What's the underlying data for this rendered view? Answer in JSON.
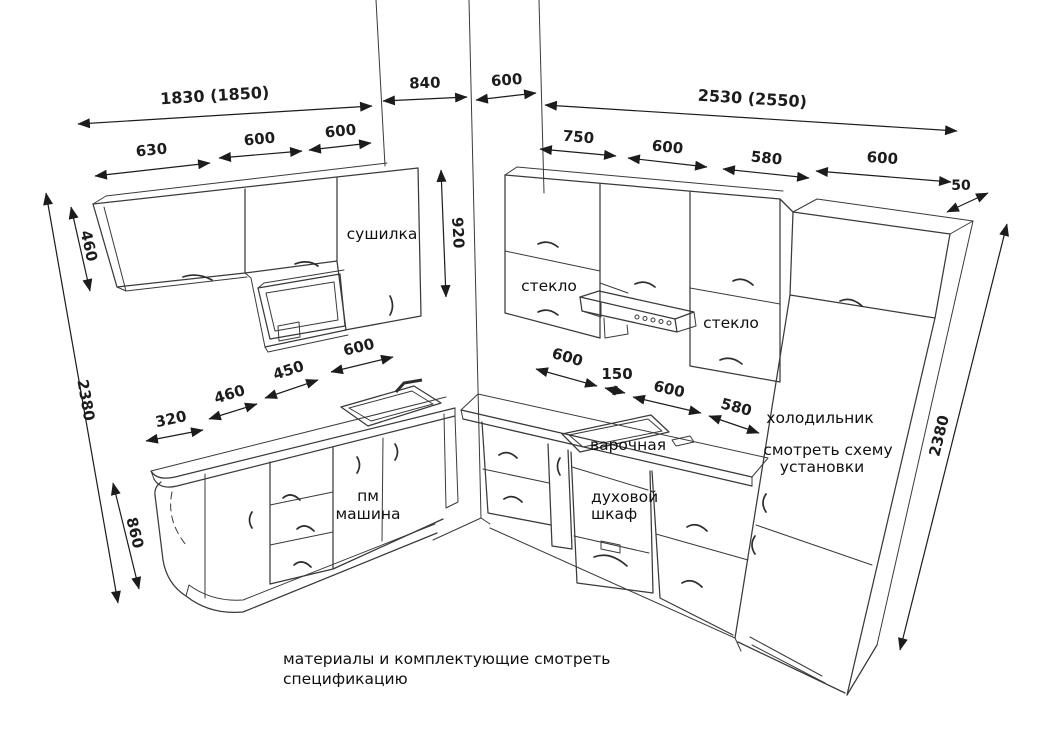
{
  "drawing": {
    "labels": {
      "dryer": "сушилка",
      "glass_left": "стекло",
      "glass_right": "стекло",
      "fridge_1": "холодильник",
      "fridge_2": "смотреть схему",
      "fridge_3": "установки",
      "hob": "варочная",
      "oven_1": "духовой",
      "oven_2": "шкаф",
      "dishwasher_1": "пм",
      "dishwasher_2": "машина"
    },
    "dims": {
      "total_left": "1830 (1850)",
      "left_sections": [
        "630",
        "600",
        "600"
      ],
      "wall_left": "840",
      "wall_right": "600",
      "total_right": "2530 (2550)",
      "right_sections": [
        "750",
        "600",
        "580",
        "600"
      ],
      "overhang": "50",
      "height_left": "2380",
      "height_upper_left": "460",
      "height_upper_mid": "920",
      "height_base": "860",
      "height_right": "2380",
      "base_left_sections": [
        "320",
        "460",
        "450",
        "600"
      ],
      "base_right_sections": [
        "600",
        "150",
        "600",
        "580"
      ]
    },
    "note_1": "материалы и комплектующие смотреть",
    "note_2": "спецификацию",
    "colors": {
      "line": "#3a3a3a",
      "dimension": "#1c1c1c",
      "text": "#111111",
      "background": "#ffffff"
    }
  }
}
